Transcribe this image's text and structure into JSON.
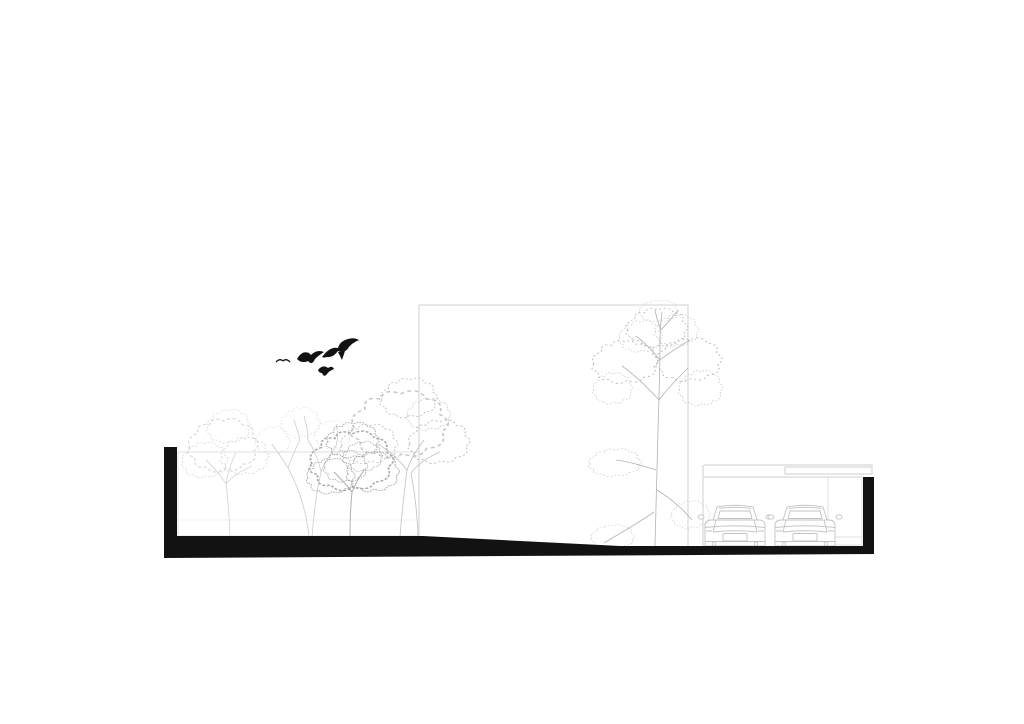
{
  "meta": {
    "description": "architectural-section-elevation-drawing",
    "background": "#ffffff"
  },
  "colors": {
    "ink": "#121212",
    "boxStroke": "#d4d4d4",
    "carportStroke": "#cfcfcf",
    "carStroke": "#c3c3c3",
    "faint": "#e2e2e2",
    "faint2": "#efefef",
    "tree1": "#d8d8d8",
    "tree2": "#cccccc",
    "tree3": "#a9a9a9",
    "tree4": "#c4c4c4",
    "tree5": "#b5b5b5"
  },
  "objects": {
    "ground": "ground-section-cut",
    "leftWall": "retaining-wall-left",
    "rightWall": "retaining-wall-right",
    "terrace": "terrace-ground-line",
    "building": "building-volume",
    "carport": "carport",
    "cars": [
      "car-left",
      "car-right"
    ],
    "trees": [
      "tree-1",
      "tree-2",
      "tree-3",
      "tree-4",
      "tree-tall"
    ],
    "birds": [
      "bird-small-1",
      "bird-medium",
      "bird-small-2",
      "bird-large"
    ]
  }
}
